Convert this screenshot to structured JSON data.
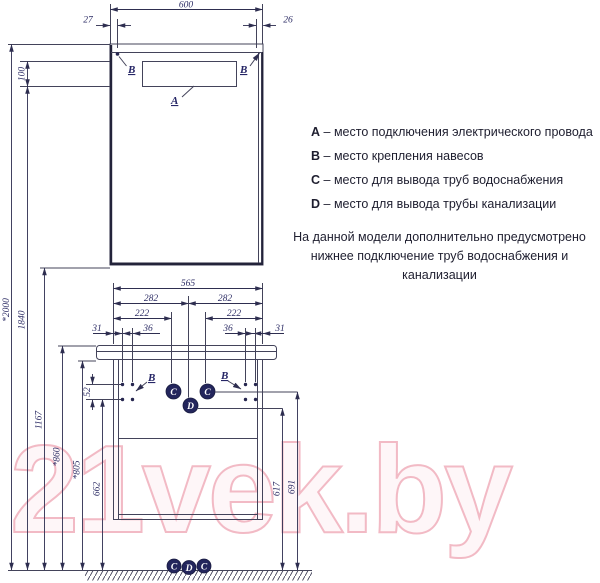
{
  "watermark": "21vek.by",
  "legend": {
    "items": [
      {
        "key": "A",
        "desc": "– место подключения электрического провода"
      },
      {
        "key": "B",
        "desc": "– место крепления навесов"
      },
      {
        "key": "C",
        "desc": "– место для вывода труб водоснабжения"
      },
      {
        "key": "D",
        "desc": "– место для вывода трубы канализации"
      }
    ],
    "note1": "На данной модели дополнительно предусмотрено",
    "note2": "нижнее подключение труб водоснабжения и канализации"
  },
  "markers": {
    "a": "А",
    "b": "В",
    "c": "C",
    "d": "D"
  },
  "dims": {
    "width_total": "600",
    "offset_left": "27",
    "offset_right": "26",
    "electric_zone_height": "100",
    "height_total": "*2000",
    "height_mount_top": "1840",
    "height_mirror_bottom": "1167",
    "height_countertop": "*860",
    "height_apron": "*805",
    "height_hanger": "662",
    "hanger_spacing": "52",
    "cabinet_width": "565",
    "center_left": "282",
    "center_right": "282",
    "pipe_left": "222",
    "pipe_right": "222",
    "edge_left": "31",
    "edge_right": "31",
    "gap_left": "36",
    "gap_right": "36",
    "height_drain": "617",
    "height_water": "691"
  },
  "colors": {
    "line": "#43435a",
    "label": "#2e2e66",
    "marker_fill": "#23255c",
    "watermark": "#f2bac5"
  }
}
